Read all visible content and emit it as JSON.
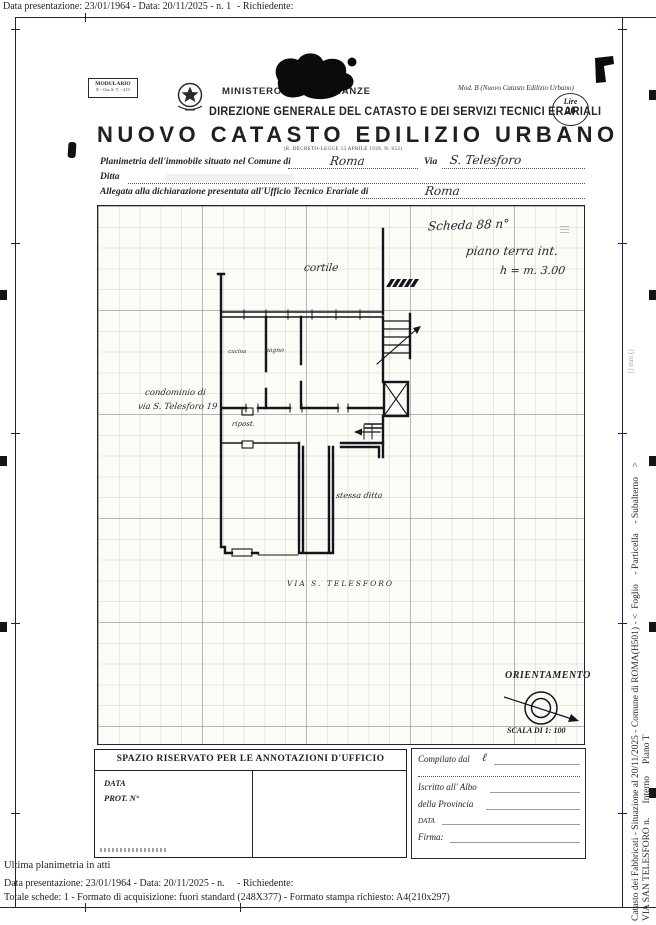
{
  "colors": {
    "ink": "#1f1f26",
    "frame": "#23233a",
    "paper": "#ffffff"
  },
  "page": {
    "top_bar_left": "Data presentazione: 23/01/1964 - Data: 20/11/2025 - n. 1",
    "top_bar_right": "- Richiedente:"
  },
  "header": {
    "modulario_line1": "MODULARIO",
    "modulario_line2": "F. - Gn. S. T. - 213",
    "ministero": "MINISTERO DELLE FINANZE",
    "direzione": "DIREZIONE GENERALE DEL CATASTO E DEI SERVIZI TECNICI ERARIALI",
    "mod_b": "Mod. B (Nuovo Catasto Edilizio Urbano)",
    "stamp_top": "Lire",
    "stamp_value": "20"
  },
  "title_block": {
    "title": "NUOVO CATASTO EDILIZIO URBANO",
    "subtitle": "(R. DECRETO-LEGGE 13 APRILE 1939, N. 652)"
  },
  "form": {
    "line1_label": "Planimetria dell'immobile situato nel Comune di",
    "line1_value": "Roma",
    "via_label": "Via",
    "via_value": "S. Telesforo",
    "ditta_label": "Ditta",
    "line3_label": "Allegata alla dichiarazione presentata all'Ufficio Tecnico Erariale di",
    "line3_value": "Roma"
  },
  "plan": {
    "scheda_note": "Scheda 88 n°",
    "floor_note": "piano terra int.",
    "height_note": "h = m. 3.00",
    "cortile_label": "cortile",
    "condominio_line1": "condominio di",
    "condominio_line2": "via S. Telesforo 19",
    "room_kitchen": "cucina",
    "room_bath": "bagno",
    "room_storage": "ripost.",
    "stessa_ditta": "stessa ditta",
    "street_label": "VIA S. TELESFORO",
    "orientation_label": "ORIENTAMENTO",
    "scale_label": "SCALA DI 1: 100"
  },
  "annotations_box": {
    "header": "SPAZIO RISERVATO PER LE ANNOTAZIONI D'UFFICIO",
    "data_label": "DATA",
    "prot_label": "PROT. N°"
  },
  "compilato_box": {
    "compilato_label": "Compilato dal",
    "compilato_hand": "ℓ",
    "iscritto_label": "Iscritto all' Albo",
    "provincia_label": "della Provincia",
    "data_label": "DATA",
    "firma_label": "Firma:"
  },
  "footer": {
    "ultima": "Ultima planimetria in atti",
    "line1_left": "Data presentazione: 23/01/1964 - Data: 20/11/2025 - n.",
    "line1_right": "- Richiedente:",
    "line2": "Totale schede: 1 - Formato di acquisizione: fuori standard (248X377) - Formato stampa richiesto: A4(210x297)"
  },
  "side_captions": {
    "line1": "Catasto dei Fabbricati - Situazione al 20/11/2025 - Comune di ROMA(H501) - <  Foglio    - Particella    - Subalterno    >",
    "line2": "VIA SAN TELESFORO n.      Interno     Piano T",
    "faint_note": "[] mm ()"
  }
}
